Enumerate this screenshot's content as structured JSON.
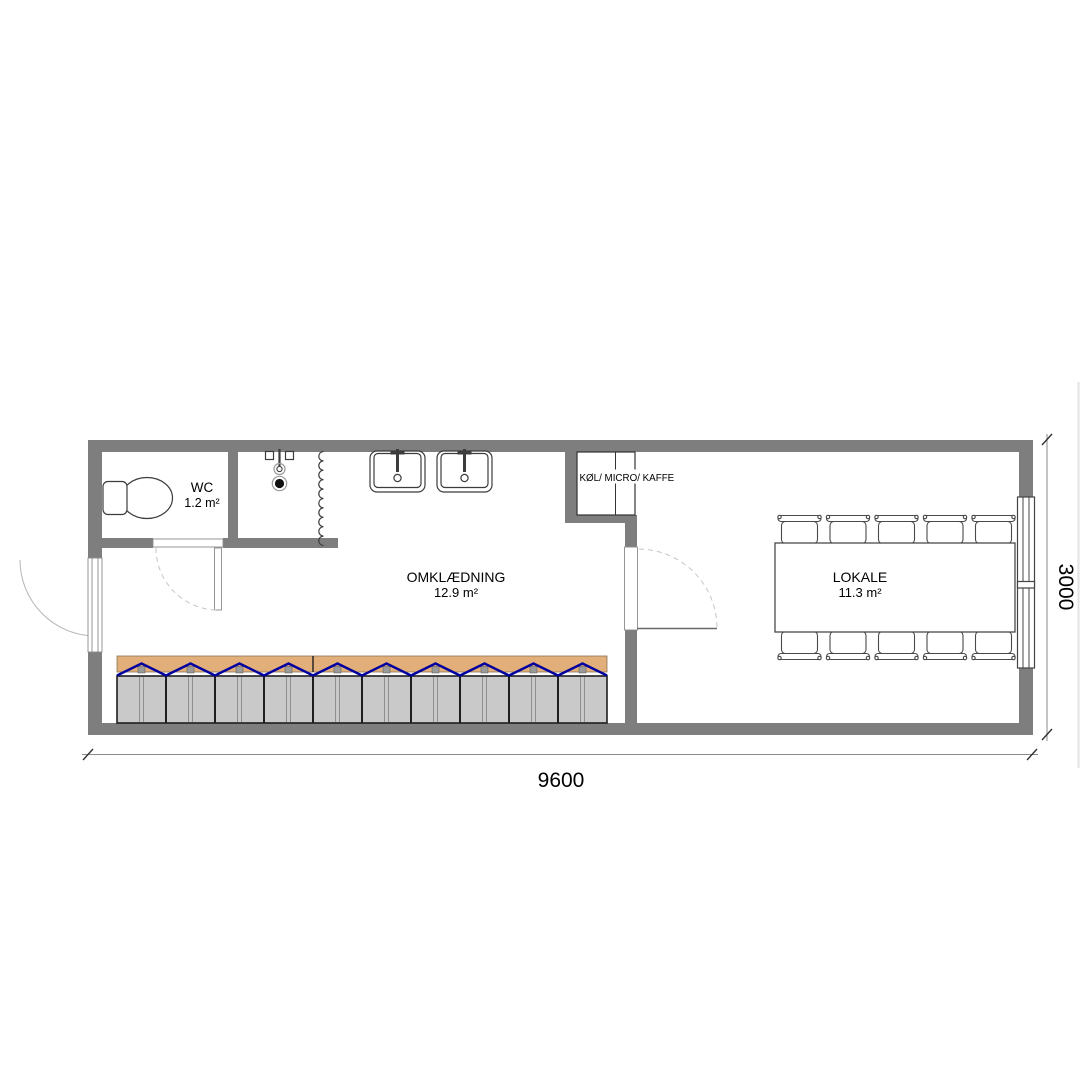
{
  "rooms": {
    "wc": {
      "name": "WC",
      "area": "1.2 m²"
    },
    "omklaedning": {
      "name": "OMKLÆDNING",
      "area": "12.9 m²"
    },
    "lokale": {
      "name": "LOKALE",
      "area": "11.3 m²"
    }
  },
  "kitchenette": {
    "label": "KØL/ MICRO/ KAFFE"
  },
  "dimensions": {
    "width_mm": "9600",
    "depth_mm": "3000"
  },
  "colors": {
    "wall": "#7E7E7E",
    "bench": "#E2AF7B",
    "brace": "#0000A0",
    "locker": "#C9C9C9"
  }
}
